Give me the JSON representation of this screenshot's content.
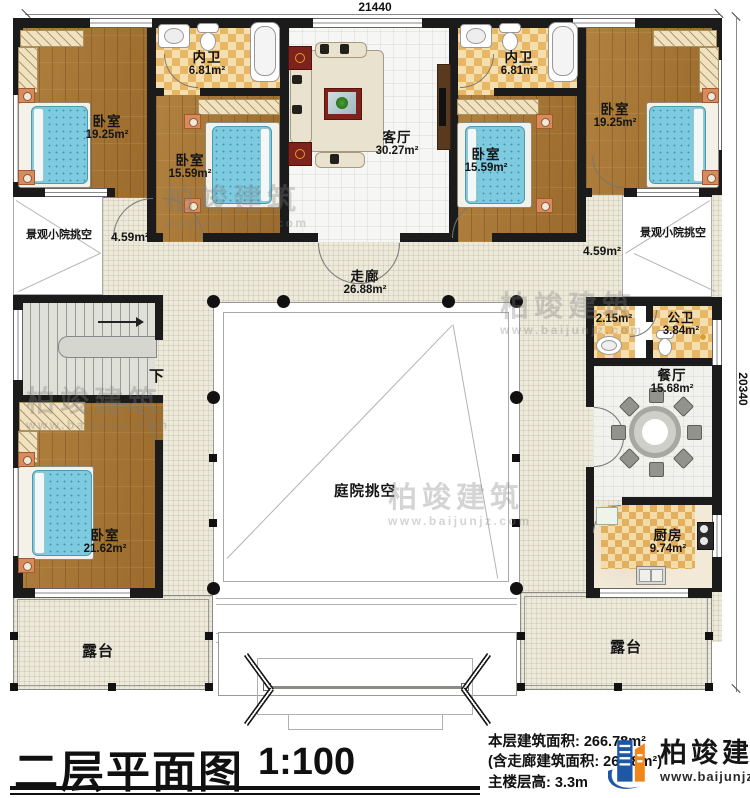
{
  "dimensions": {
    "top": "21440",
    "right": "20340"
  },
  "rooms": [
    {
      "name": "卧室",
      "area": "19.25m²"
    },
    {
      "name": "内卫",
      "area": "6.81m²"
    },
    {
      "name": "卧室",
      "area": "15.59m²"
    },
    {
      "name": "客厅",
      "area": "30.27m²"
    },
    {
      "name": "内卫",
      "area": "6.81m²"
    },
    {
      "name": "卧室",
      "area": "15.59m²"
    },
    {
      "name": "卧室",
      "area": "19.25m²"
    },
    {
      "name": "景观小院挑空",
      "area": "4.59m²"
    },
    {
      "name": "景观小院挑空",
      "area": "4.59m²"
    },
    {
      "name": "走廊",
      "area": "26.88m²"
    },
    {
      "name": "卧室",
      "area": "21.62m²"
    },
    {
      "name": "庭院挑空",
      "area": ""
    },
    {
      "name": "",
      "area": "2.15m²"
    },
    {
      "name": "公卫",
      "area": "3.84m²"
    },
    {
      "name": "餐厅",
      "area": "15.68m²"
    },
    {
      "name": "厨房",
      "area": "9.74m²"
    },
    {
      "name": "露台",
      "area": ""
    },
    {
      "name": "露台",
      "area": ""
    }
  ],
  "stair": {
    "down_label": "下"
  },
  "title_block": {
    "title": "二层平面图",
    "scale": "1:100",
    "stats": [
      "本层建筑面积: 266.78m²",
      "(含走廊建筑面积: 26.88m²)",
      "主楼层高: 3.3m"
    ]
  },
  "brand": {
    "name": "柏竣建筑",
    "url": "www.baijunjz.com"
  },
  "watermark": {
    "name": "柏竣建筑",
    "url": "www.baijunjz.com"
  }
}
